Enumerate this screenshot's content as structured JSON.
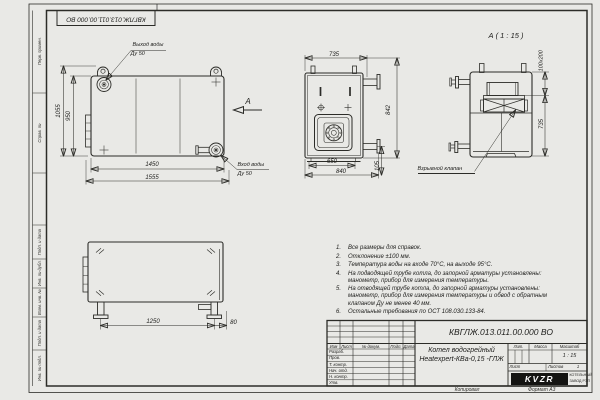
{
  "page": {
    "top_designation": "КВГЛЖ.013.011.00.000 ВО",
    "copied": "Копировал",
    "format": "Формат А3"
  },
  "frame_left": {
    "cells": [
      {
        "label": "Перв. примен."
      },
      {
        "label": "Справ. №"
      },
      {
        "label": "Подп. и дата"
      },
      {
        "label": "Инв. № дубл."
      },
      {
        "label": "Взам. инв. №"
      },
      {
        "label": "Подп. и дата"
      },
      {
        "label": "Инв. № подл."
      }
    ]
  },
  "views": {
    "main": {
      "outlet_label": "Выход воды",
      "outlet_dn": "Ду 50",
      "inlet_label": "Вход воды",
      "inlet_dn": "Ду 50",
      "arrow_label": "А",
      "dim_height_outer": "1055",
      "dim_height_inner": "950",
      "dim_width_inner": "1450",
      "dim_width_outer": "1555"
    },
    "front": {
      "dim_top": "735",
      "dim_right": "842",
      "dim_bottom_inner": "650",
      "dim_bottom_outer": "840",
      "dim_side": "105"
    },
    "detail": {
      "title": "А ( 1 : 15 )",
      "dim_valve": "100х200",
      "dim_height": "735",
      "valve_label": "Взрывной клапан"
    },
    "bottom": {
      "dim_length": "1250",
      "dim_offset": "80"
    }
  },
  "notes": [
    {
      "num": "1.",
      "text": "Все размеры для справок."
    },
    {
      "num": "2.",
      "text": "Отклонение ±100 мм."
    },
    {
      "num": "3.",
      "text": "Температура воды на входе 70°С, на выходе 95°С."
    },
    {
      "num": "4.",
      "text": "На подводящей трубе котла, до запорной арматуры установлены: манометр, прибор для измерения температуры."
    },
    {
      "num": "5.",
      "text": "На отводящей трубе котла, до запорной арматуры установлены: манометр, прибор для измерения температуры и обвод с обратным клапаном Ду не менее 40 мм."
    },
    {
      "num": "6.",
      "text": "Остальные требования по ОСТ 108.030.133-84."
    }
  ],
  "title_block": {
    "designation": "КВГЛЖ.013.011.00.000 ВО",
    "product_name_1": "Котел водогрейный",
    "product_name_2": "Heatexpert-КВа-0,15 -ГЛЖ",
    "col_izm": "Изм",
    "col_list": "Лист",
    "col_doc": "№ докум.",
    "col_sign": "Подп.",
    "col_date": "Дата",
    "row_labels": [
      "Разраб.",
      "Пров.",
      "Т. контр.",
      "Нач. отд.",
      "Н. контр.",
      "Утв."
    ],
    "lit": "Лит.",
    "mass": "Масса",
    "scale": "Масштаб",
    "scale_value": "1 : 15",
    "sheet": "Лист",
    "sheets": "Листов",
    "sheets_value": "1",
    "logo_text": "KVZR",
    "company_1": "КОТЕЛЬНЫЙ",
    "company_2": "ЗАВОД РЭП"
  },
  "colors": {
    "line": "#2c2c28",
    "paper": "#fcfcfa"
  }
}
